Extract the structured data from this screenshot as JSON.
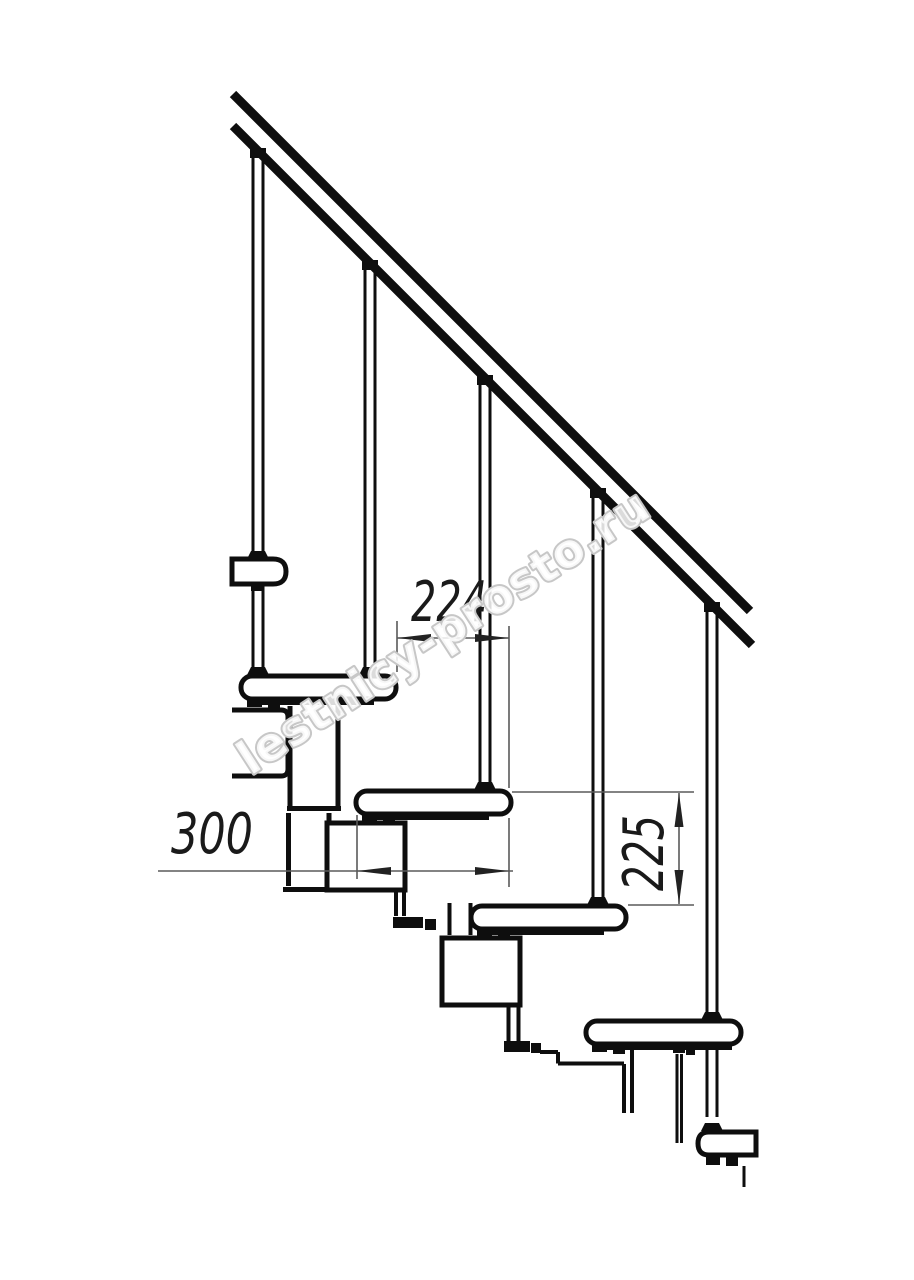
{
  "page": {
    "background": "#ffffff"
  },
  "watermark": {
    "text": "lestnicy-prosto.ru",
    "color": "#c7c7c7"
  },
  "dimensions": {
    "step_run": {
      "label": "224",
      "orientation": "horizontal"
    },
    "tread_depth": {
      "label": "300",
      "orientation": "horizontal"
    },
    "step_rise": {
      "label": "225",
      "orientation": "vertical"
    }
  },
  "drawing": {
    "type": "modular-staircase-side-view",
    "ink_color": "#0e0e0e",
    "dim_color": "#5a5a5a",
    "label_color": "#1a1a1a",
    "components": {
      "handrail": 1,
      "balusters": 5,
      "treads": 6,
      "support_modules": 3
    }
  }
}
